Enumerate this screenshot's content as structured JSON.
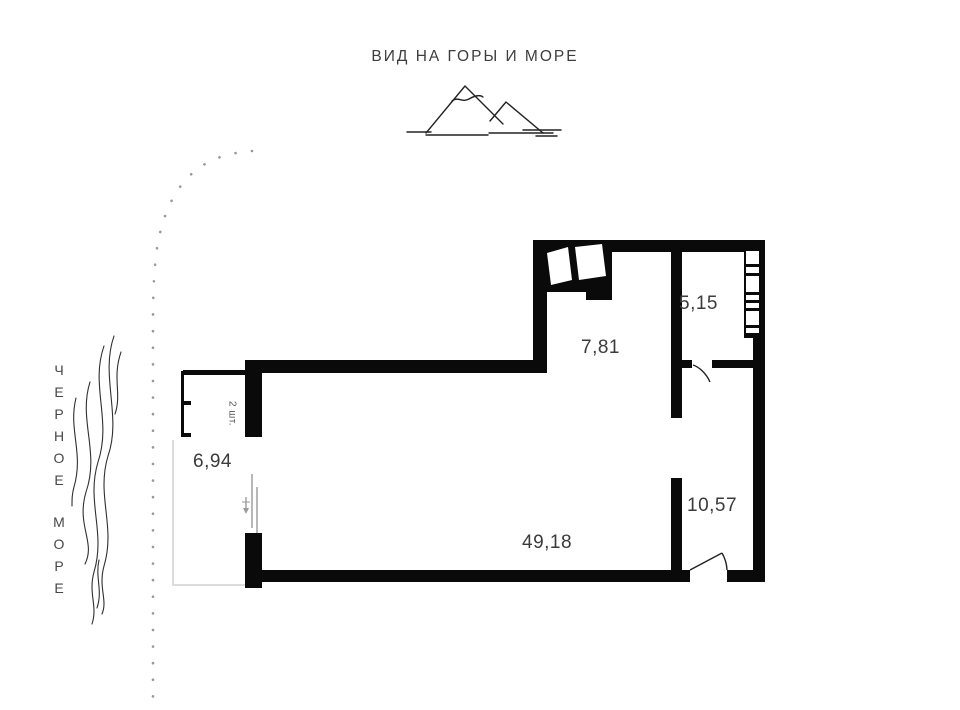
{
  "header": {
    "title": "ВИД НА ГОРЫ И МОРЕ"
  },
  "sea": {
    "word1": "ЧЕРНОЕ",
    "word2": "МОРЕ"
  },
  "plan": {
    "areas": {
      "balcony": "6,94",
      "kitchen": "7,81",
      "hall": "5,15",
      "corridor": "10,57",
      "living": "49,18"
    },
    "notes": {
      "window_count": "2 шт."
    }
  },
  "icons": {
    "mountains": "mountains-and-sea-icon",
    "waves": "sea-waves-icon",
    "shore": "shoreline-dotted-icon"
  },
  "colors": {
    "wall": "#0a0a0a",
    "label_text": "#3b3b3b",
    "title_text": "#3d3d3d",
    "dotted_shore": "#999999",
    "thin_line": "#2f2f2f",
    "faint_outline": "#dcdcdc",
    "slider_line": "#9a9a9a"
  }
}
